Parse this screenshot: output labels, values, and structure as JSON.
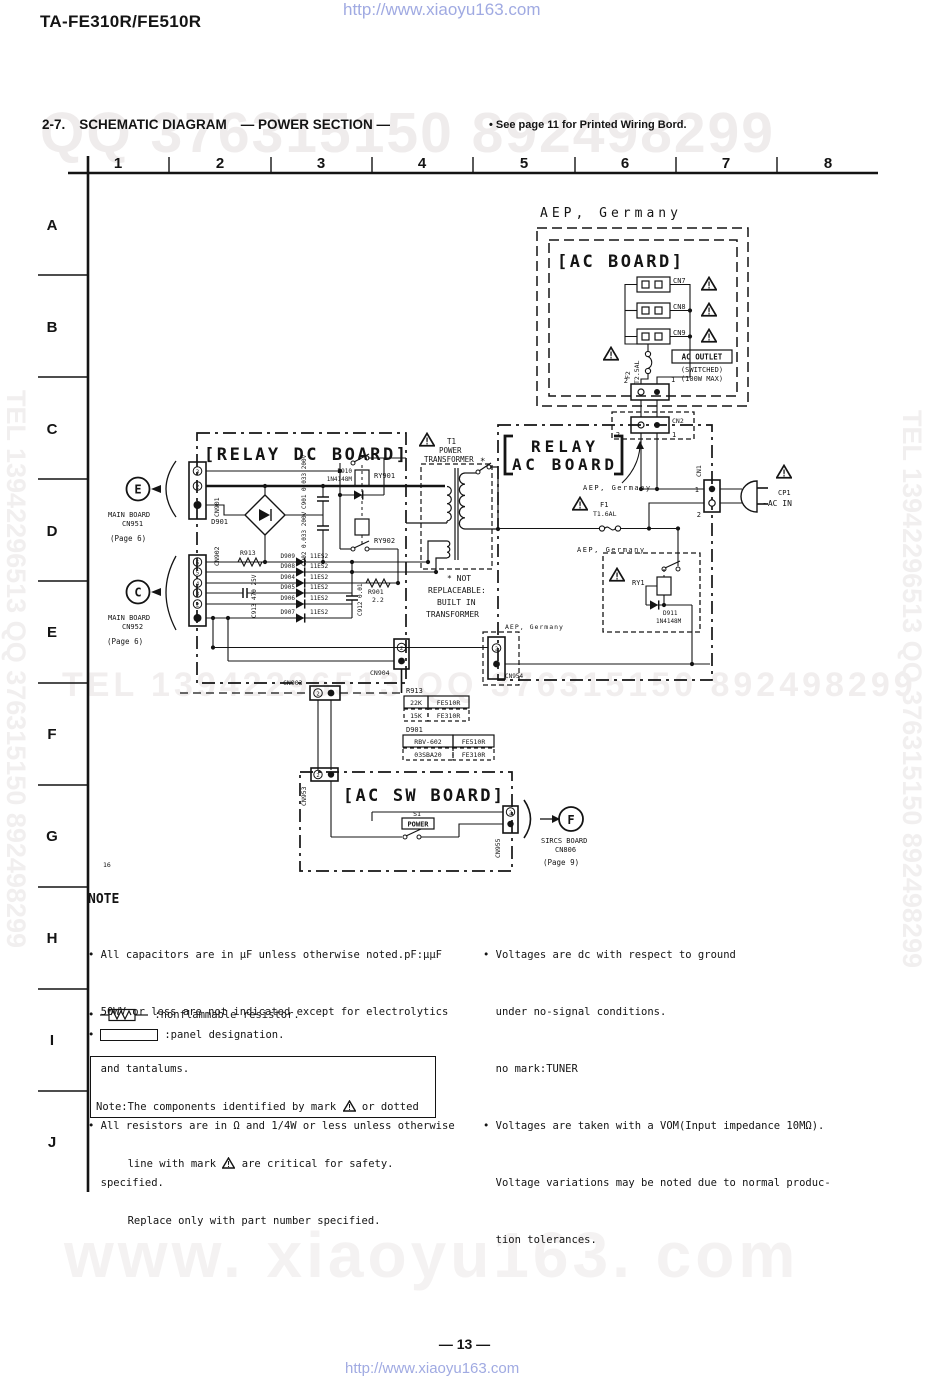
{
  "page": {
    "title": "TA-FE310R/FE510R",
    "page_number": "— 13 —",
    "link": "http://www.xiaoyu163.com",
    "wm_heading": "QQ 376315150    892498299",
    "wm_mid": "TEL  13942296513      QQ  376315150  892498299",
    "wm_vertical": "TEL 13942296513 QQ 376315150 892498299",
    "wm_big": "www. xiaoyu163. com"
  },
  "heading": {
    "section": "2-7.",
    "title": "SCHEMATIC DIAGRAM",
    "subtitle": "— POWER SECTION —",
    "ref": "• See page 11 for Printed Wiring Bord."
  },
  "grid": {
    "columns": [
      "1",
      "2",
      "3",
      "4",
      "5",
      "6",
      "7",
      "8"
    ],
    "rows": [
      "A",
      "B",
      "C",
      "D",
      "E",
      "F",
      "G",
      "H",
      "I",
      "J"
    ]
  },
  "schematic": {
    "labels": {
      "aep_top": "AEP, Germany",
      "aep": "AEP, Germany",
      "ac_board_title": "[AC BOARD]",
      "relay_dc_title": "[RELAY DC BOARD]",
      "relay_ac_1": "RELAY",
      "relay_ac_2": "AC BOARD",
      "ac_sw_title": "[AC SW BOARD]",
      "cn7": "CN7",
      "cn8": "CN8",
      "cn9": "CN9",
      "f2": "F2",
      "f2_rating": "T2.5AL",
      "ac_outlet": "AC OUTLET",
      "ac_switched": "(SWITCHED)",
      "ac_max": "(100W MAX)",
      "pin_1": "1",
      "pin_2": "2",
      "pin_3": "3",
      "pin_4": "4",
      "pin_5": "5",
      "pin_6": "6",
      "cn2": "CN2",
      "cn1": "CN1",
      "e_ref": "E",
      "c_ref": "C",
      "f_ref": "F",
      "main_board": "MAIN BOARD",
      "cn951": "CN951",
      "cn952": "CN952",
      "page6": "(Page 6)",
      "cn901": "CN901",
      "cn902": "CN902",
      "d901": "D901",
      "c901": "C901 0.033 200V",
      "c902": "C902 0.033 200V",
      "d910": "D910",
      "d910_type": "1N4148M",
      "ry901": "RY901",
      "ry902": "RY902",
      "r913": "R913",
      "d909": "D909",
      "d908": "D908",
      "d904": "D904",
      "d905": "D905",
      "d906": "D906",
      "d907": "D907",
      "diode_type": "11ES2",
      "c913": "C913 470 25V",
      "r901": "R901",
      "r901_val": "2.2",
      "c912": "C912 0.01",
      "t1": "T1",
      "t1_power": "POWER",
      "t1_transformer": "TRANSFORMER",
      "star": "*",
      "nr1": "* NOT",
      "nr2": "REPLACEABLE:",
      "nr3": "BUILT IN",
      "nr4": "TRANSFORMER",
      "f1": "F1",
      "f1_rating": "T1.6AL",
      "ry1": "RY1",
      "d911": "D911",
      "d911_type": "1N4148M",
      "cp1": "CP1",
      "ac_in": "~AC IN",
      "cn954": "CN954",
      "cn904": "CN904",
      "cn903": "CN903",
      "r913_22k": "22K",
      "r913_15k": "15K",
      "fe510r": "FE510R",
      "fe310r": "FE310R",
      "d901_a": "RBV-602",
      "d901_b": "03SBA20",
      "cn953": "CN953",
      "s1": "S1",
      "power_sw": "POWER",
      "cn955": "CN955",
      "sircs_board": "SIRCS BOARD",
      "cn806": "CN806",
      "page9": "(Page 9)",
      "ref_16": "16"
    }
  },
  "notes": {
    "heading": "NOTE",
    "left": [
      "• All capacitors are in µF unless otherwise noted.pF:µµF",
      "  50WV or less are not indicated except for electrolytics",
      "  and tantalums.",
      "• All resistors are in Ω and 1/4W or less unless otherwise",
      "  specified."
    ],
    "right": [
      "• Voltages are dc with respect to ground",
      "  under no-signal conditions.",
      "  no mark:TUNER",
      "• Voltages are taken with a VOM(Input impedance 10MΩ).",
      "  Voltage variations may be noted due to normal produc-",
      "  tion tolerances."
    ],
    "sym1_bullet": "•",
    "sym1_text": ":nonflammable resistor.",
    "sym2_bullet": "•",
    "sym2_text": ":panel designation.",
    "safety": {
      "l1a": "Note:The components identified by mark ",
      "l1b": " or dotted",
      "l2a": "     line with mark ",
      "l2b": " are critical for safety.",
      "l3": "     Replace only with part number specified."
    }
  }
}
